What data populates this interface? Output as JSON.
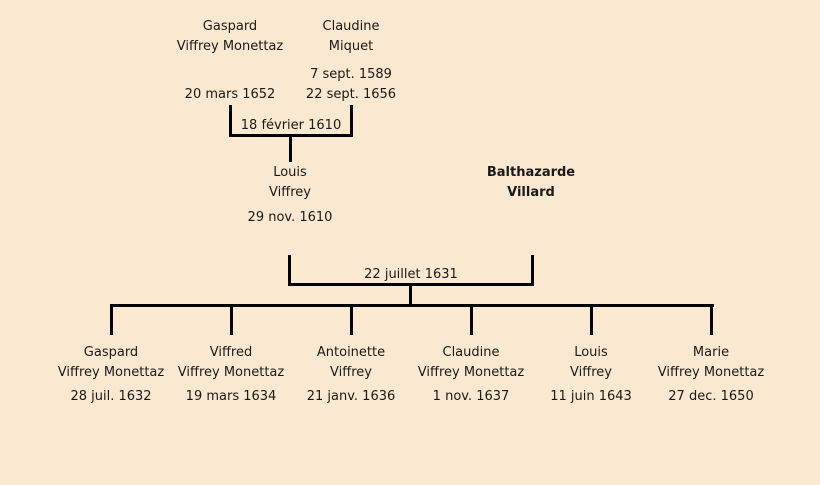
{
  "canvas": {
    "background_color": "#fae8d0",
    "line_color": "#000000",
    "text_color": "#1a1a1a"
  },
  "tree": {
    "grandparents": {
      "father": {
        "given": "Gaspard",
        "surname": "Viffrey Monettaz",
        "date": "20 mars 1652"
      },
      "mother": {
        "given": "Claudine",
        "surname": "Miquet",
        "dates": [
          "7 sept. 1589",
          "22 sept. 1656"
        ]
      }
    },
    "marriages": [
      {
        "date": "18 février 1610"
      },
      {
        "date": "22 juillet 1631"
      }
    ],
    "parents": {
      "father": {
        "given": "Louis",
        "surname": "Viffrey",
        "date": "29 nov. 1610"
      },
      "mother": {
        "given": "Balthazarde",
        "surname": "Villard"
      }
    },
    "children": [
      {
        "given": "Gaspard",
        "surname": "Viffrey Monettaz",
        "date": "28 juil. 1632"
      },
      {
        "given": "Viffred",
        "surname": "Viffrey Monettaz",
        "date": "19 mars 1634"
      },
      {
        "given": "Antoinette",
        "surname": "Viffrey",
        "date": "21 janv. 1636"
      },
      {
        "given": "Claudine",
        "surname": "Viffrey Monettaz",
        "date": "1 nov. 1637"
      },
      {
        "given": "Louis",
        "surname": "Viffrey",
        "date": "11 juin 1643"
      },
      {
        "given": "Marie",
        "surname": "Viffrey Monettaz",
        "date": "27 dec. 1650"
      }
    ]
  }
}
